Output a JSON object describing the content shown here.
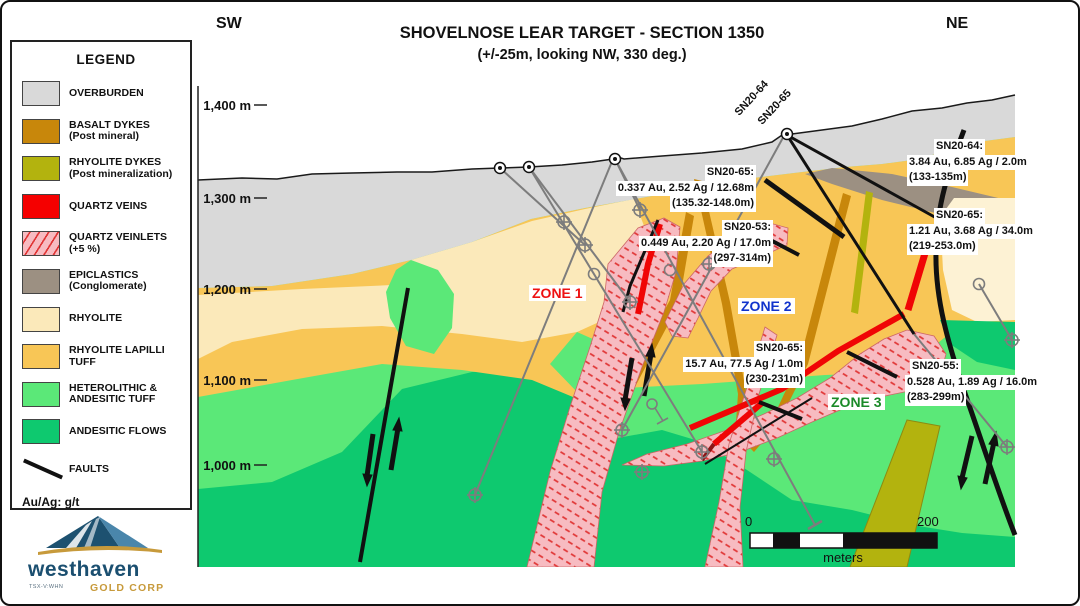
{
  "header": {
    "title": "SHOVELNOSE LEAR TARGET - SECTION 1350",
    "subtitle": "(+/-25m, looking NW, 330 deg.)",
    "sw": "SW",
    "ne": "NE"
  },
  "legend": {
    "title": "LEGEND",
    "items": [
      {
        "label": "OVERBURDEN",
        "sublabel": "",
        "color": "#d9d9d9"
      },
      {
        "label": "BASALT DYKES",
        "sublabel": "(Post mineral)",
        "color": "#c8870b"
      },
      {
        "label": "RHYOLITE DYKES",
        "sublabel": "(Post mineralization)",
        "color": "#b3b30e"
      },
      {
        "label": "QUARTZ VEINS",
        "sublabel": "",
        "color": "#f50000"
      },
      {
        "label": "QUARTZ VEINLETS",
        "sublabel": "(+5 %)",
        "color": "#f7bbc1"
      },
      {
        "label": "EPICLASTICS",
        "sublabel": "(Conglomerate)",
        "color": "#9c9082"
      },
      {
        "label": "RHYOLITE",
        "sublabel": "",
        "color": "#fbe9ba"
      },
      {
        "label": "RHYOLITE LAPILLI TUFF",
        "sublabel": "",
        "color": "#f8c656"
      },
      {
        "label": "HETEROLITHIC & ANDESITIC TUFF",
        "sublabel": "",
        "color": "#5be878"
      },
      {
        "label": "ANDESITIC FLOWS",
        "sublabel": "",
        "color": "#0ec96f"
      }
    ],
    "fault_label": "FAULTS",
    "footnote": "Au/Ag: g/t"
  },
  "axis": {
    "labels": [
      "1,400 m",
      "1,300 m",
      "1,200 m",
      "1,100 m",
      "1,000 m"
    ]
  },
  "zones": [
    "ZONE 1",
    "ZONE 2",
    "ZONE 3"
  ],
  "collar_labels": [
    "SN20-64",
    "SN20-65"
  ],
  "annotations": [
    {
      "hole": "SN20-65:",
      "assay": "0.337 Au, 2.52 Ag / 12.68m",
      "interval": "(135.32-148.0m)"
    },
    {
      "hole": "SN20-53:",
      "assay": "0.449 Au, 2.20 Ag / 17.0m",
      "interval": "(297-314m)"
    },
    {
      "hole": "SN20-64:",
      "assay": "3.84 Au, 6.85 Ag / 2.0m",
      "interval": "(133-135m)"
    },
    {
      "hole": "SN20-65:",
      "assay": "1.21 Au, 3.68 Ag / 34.0m",
      "interval": "(219-253.0m)"
    },
    {
      "hole": "SN20-65:",
      "assay": "15.7 Au, 77.5 Ag / 1.0m",
      "interval": "(230-231m)"
    },
    {
      "hole": "SN20-55:",
      "assay": "0.528 Au, 1.89 Ag / 16.0m",
      "interval": "(283-299m)"
    }
  ],
  "scale_bar": {
    "start": "0",
    "end": "200",
    "unit": "meters"
  },
  "logo": {
    "name": "westhaven",
    "division": "GOLD CORP",
    "ticker": "TSX-V:WHN"
  },
  "colors": {
    "overburden": "#d9d9d9",
    "rhyolite": "#fbe9ba",
    "rhyolite_pale": "#fdf2d4",
    "lapilli_tuff": "#f8c656",
    "heterolithic_tuff": "#5be878",
    "andesitic_flows": "#0ec96f",
    "epiclastics": "#9c9082",
    "basalt_dyke": "#c8870b",
    "rhyolite_dyke": "#b3b30e",
    "quartz_vein": "#f50000",
    "quartz_veinlets": "#f7bbc1",
    "fault": "#111111",
    "drill_trace": "#7d7d7d"
  }
}
